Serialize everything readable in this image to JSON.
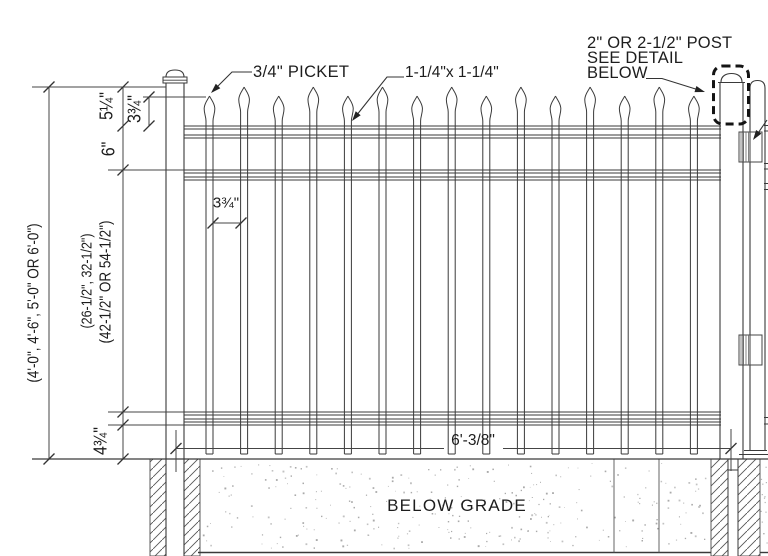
{
  "labels": {
    "picket": "3/4\" PICKET",
    "rail_size": "1-1/4\"x 1-1/4\"",
    "post_note_line1": "2\" OR 2-1/2\" POST",
    "post_note_line2": "SEE DETAIL",
    "post_note_line3": "BELOW",
    "below_grade": "BELOW GRADE"
  },
  "dimensions": {
    "overall_heights": "(4'-0\", 4'-6\", 5'-0\" OR 6'-0\")",
    "rail_spacing_options_a": "(26-1/2\", 32-1/2\")",
    "rail_spacing_options_b": "(42-1/2\" OR 54-1/2\")",
    "top_to_rail": "5¼\"",
    "picket_tip_to_rail": "3¾\"",
    "rail_to_rail": "6\"",
    "picket_gap": "3¾\"",
    "rail_to_grade": "4¾\"",
    "panel_width": "6'-3/8\""
  },
  "figure": {
    "picket_count": 15,
    "line_color": "#3a3a3a",
    "dim_color": "#444444",
    "text_color": "#1d1d1d"
  }
}
